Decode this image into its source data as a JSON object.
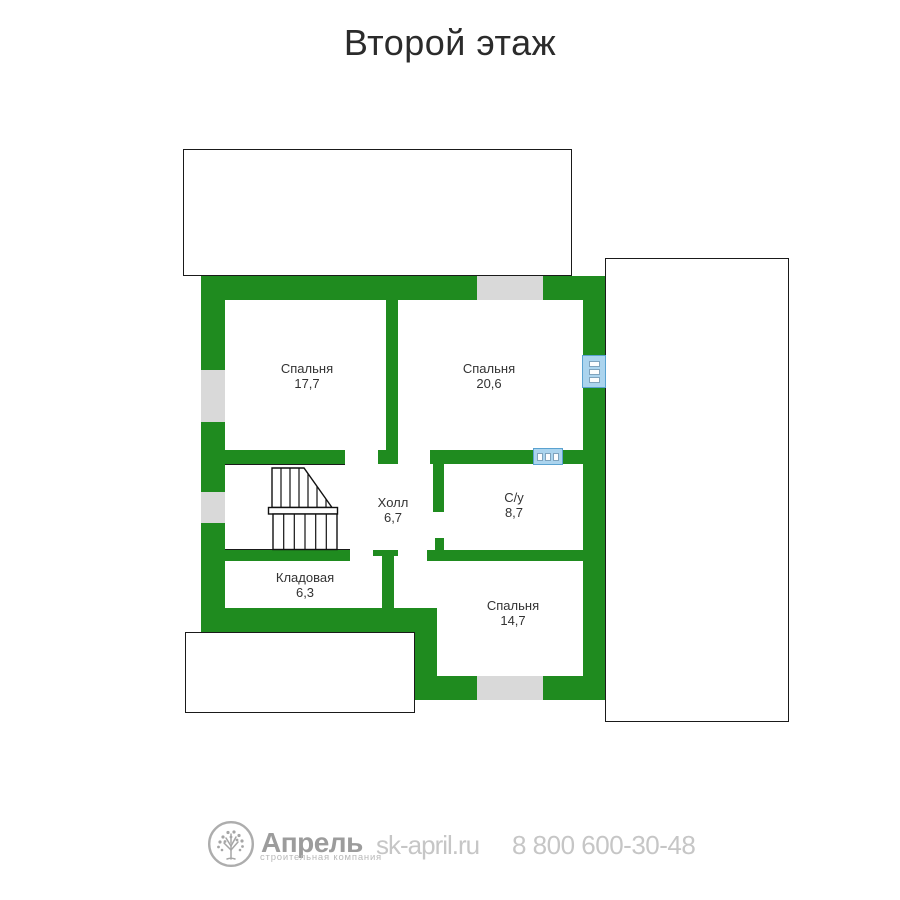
{
  "title": "Второй этаж",
  "plan": {
    "rooms": [
      {
        "name": "Спальня",
        "area": "17,7"
      },
      {
        "name": "Спальня",
        "area": "20,6"
      },
      {
        "name": "Холл",
        "area": "6,7"
      },
      {
        "name": "С/у",
        "area": "8,7"
      },
      {
        "name": "Кладовая",
        "area": "6,3"
      },
      {
        "name": "Спальня",
        "area": "14,7"
      }
    ]
  },
  "footer": {
    "logo_icon": "tree-icon",
    "brand": "Апрель",
    "tagline": "строительная компания",
    "website": "sk-april.ru",
    "phone": "8 800 600-30-48"
  },
  "colors": {
    "wall": "#1f8b1f",
    "window": "#d9d9d9",
    "fixture_fill": "#abd4ee",
    "fixture_border": "#5aa2d0",
    "label": "#333333",
    "line": "#1a1a1a",
    "brand_gray": "#9c9c9c",
    "footer_gray": "#c6c6c6"
  }
}
